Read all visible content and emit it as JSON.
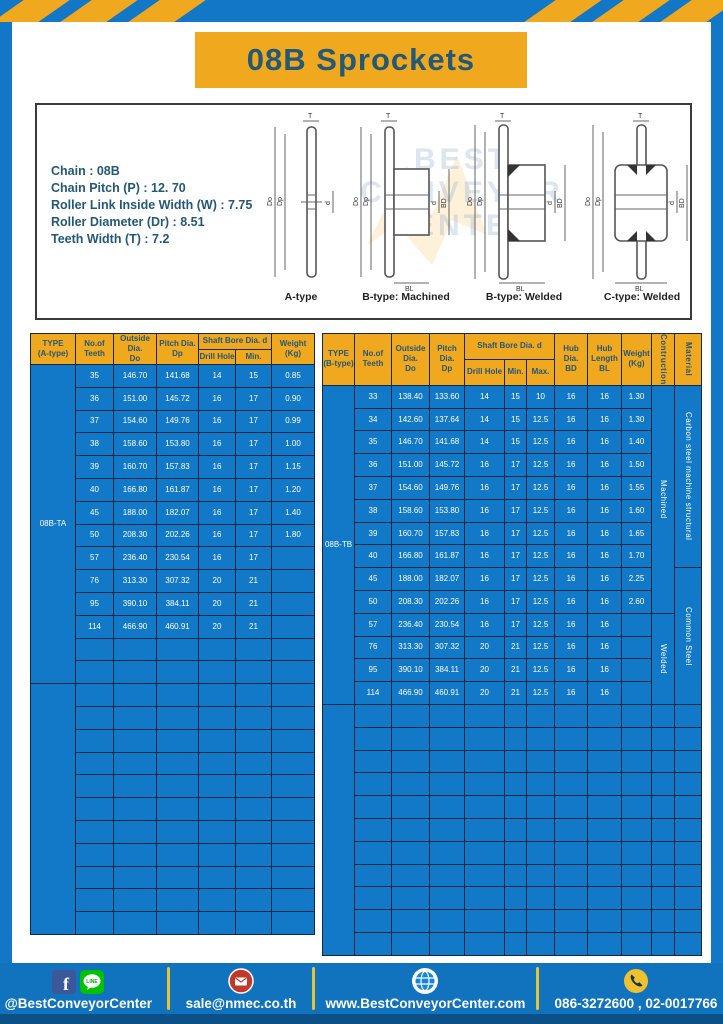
{
  "title": "08B Sprockets",
  "specs": {
    "lines": "Chain : 08B\nChain Pitch (P) : 12. 70\nRoller Link Inside Width (W) : 7.75\nRoller Diameter (Dr) : 8.51\nTeeth Width (T) : 7.2"
  },
  "watermark": "BEST\nCONVEYOR\nCENTER",
  "diagram_labels": [
    "A-type",
    "B-type: Machined",
    "B-type: Welded",
    "C-type: Welded"
  ],
  "dims": {
    "t": "T",
    "do": "Do",
    "dp": "Dp",
    "d": "d",
    "bd": "BD",
    "bl": "BL"
  },
  "table_a": {
    "type_label": "08B-TA",
    "headers": {
      "type": "TYPE\n(A-type)",
      "teeth": "No.of\nTeeth",
      "outside": "Outside\nDia.\nDo",
      "pitch": "Pitch Dia.\nDp",
      "shaft_bore": "Shaft Bore Dia. d",
      "drill": "Drill Hole",
      "min": "Min.",
      "weight": "Weight\n(Kg)"
    },
    "col_widths": [
      45,
      38,
      43,
      42,
      37,
      36,
      43
    ],
    "rows": [
      [
        "35",
        "146.70",
        "141.68",
        "14",
        "15",
        "0.85"
      ],
      [
        "36",
        "151.00",
        "145.72",
        "16",
        "17",
        "0.90"
      ],
      [
        "37",
        "154.60",
        "149.76",
        "16",
        "17",
        "0.99"
      ],
      [
        "38",
        "158.60",
        "153.80",
        "16",
        "17",
        "1.00"
      ],
      [
        "39",
        "160.70",
        "157.83",
        "16",
        "17",
        "1.15"
      ],
      [
        "40",
        "166.80",
        "161.87",
        "16",
        "17",
        "1.20"
      ],
      [
        "45",
        "188.00",
        "182.07",
        "16",
        "17",
        "1.40"
      ],
      [
        "50",
        "208.30",
        "202.26",
        "16",
        "17",
        "1.80"
      ],
      [
        "57",
        "236.40",
        "230.54",
        "16",
        "17",
        ""
      ],
      [
        "76",
        "313.30",
        "307.32",
        "20",
        "21",
        ""
      ],
      [
        "95",
        "390.10",
        "384.11",
        "20",
        "21",
        ""
      ],
      [
        "114",
        "466.90",
        "460.91",
        "20",
        "21",
        ""
      ]
    ],
    "extra_empty_rows_in_group": 2,
    "empty_group_rows": 11
  },
  "table_b": {
    "type_label": "08B-TB",
    "headers": {
      "type": "TYPE\n(B-type)",
      "teeth": "No.of\nTeeth",
      "outside": "Outside\nDia.\nDo",
      "pitch": "Pitch Dia.\nDp",
      "shaft_bore": "Shaft Bore Dia. d",
      "drill": "Drill Hole",
      "min": "Min.",
      "max": "Max.",
      "hub_dia": "Hub Dia.\nBD",
      "hub_len": "Hub\nLength\nBL",
      "weight": "Weight\n(Kg)",
      "construction": "Contruction",
      "material": "Material"
    },
    "col_widths": [
      32,
      37,
      38,
      35,
      40,
      22,
      28,
      33,
      34,
      30,
      23,
      27
    ],
    "rows": [
      [
        "33",
        "138.40",
        "133.60",
        "14",
        "15",
        "10",
        "16",
        "16",
        "1.30"
      ],
      [
        "34",
        "142.60",
        "137.64",
        "14",
        "15",
        "12.5",
        "16",
        "16",
        "1.30"
      ],
      [
        "35",
        "146.70",
        "141.68",
        "14",
        "15",
        "12.5",
        "16",
        "16",
        "1.40"
      ],
      [
        "36",
        "151.00",
        "145.72",
        "16",
        "17",
        "12.5",
        "16",
        "16",
        "1.50"
      ],
      [
        "37",
        "154.60",
        "149.76",
        "16",
        "17",
        "12.5",
        "16",
        "16",
        "1.55"
      ],
      [
        "38",
        "158.60",
        "153.80",
        "16",
        "17",
        "12.5",
        "16",
        "16",
        "1.60"
      ],
      [
        "39",
        "160.70",
        "157.83",
        "16",
        "17",
        "12.5",
        "16",
        "16",
        "1.65"
      ],
      [
        "40",
        "166.80",
        "161.87",
        "16",
        "17",
        "12.5",
        "16",
        "16",
        "1.70"
      ],
      [
        "45",
        "188.00",
        "182.07",
        "16",
        "17",
        "12.5",
        "16",
        "16",
        "2.25"
      ],
      [
        "50",
        "208.30",
        "202.26",
        "16",
        "17",
        "12.5",
        "16",
        "16",
        "2.60"
      ],
      [
        "57",
        "236.40",
        "230.54",
        "16",
        "17",
        "12.5",
        "16",
        "16",
        ""
      ],
      [
        "76",
        "313.30",
        "307.32",
        "20",
        "21",
        "12.5",
        "16",
        "16",
        ""
      ],
      [
        "95",
        "390.10",
        "384.11",
        "20",
        "21",
        "12.5",
        "16",
        "16",
        ""
      ],
      [
        "114",
        "466.90",
        "460.91",
        "20",
        "21",
        "12.5",
        "16",
        "16",
        ""
      ]
    ],
    "construction_spans": [
      {
        "label": "Machined",
        "rows": 10
      },
      {
        "label": "Welded",
        "rows": 4
      }
    ],
    "material_spans": [
      {
        "label": "Carbon steel  machine structural",
        "rows": 8
      },
      {
        "label": "Common  Steel",
        "rows": 6
      }
    ],
    "extra_empty_rows_in_group": 0,
    "empty_group_rows": 11
  },
  "footer": {
    "social_handle": "@BestConveyorCenter",
    "line_label": "LINE",
    "facebook_letter": "f",
    "email": "sale@nmec.co.th",
    "website": "www.BestConveyorCenter.com",
    "phone": "086-3272600 , 02-0017766"
  },
  "colors": {
    "blue": "#1277C6",
    "footer_blue": "#1173BE",
    "yellow": "#F0A81E",
    "divider_yellow": "#E6C235",
    "navy_text": "#235877",
    "grid_line": "#13293F",
    "bottom_strip": "#0B5188",
    "line_green": "#00C300",
    "mail_red": "#C0392B",
    "fb_blue": "#3B5998",
    "phone_yellow": "#EFC12F"
  }
}
